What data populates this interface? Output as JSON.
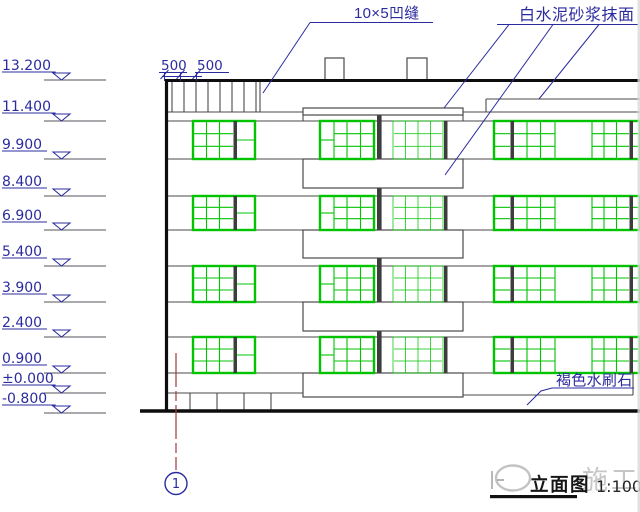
{
  "drawing": {
    "annotations": {
      "groove_label": "10×5凹缝",
      "white_cement_label": "白水泥砂浆抹面",
      "brown_stone_label": "褐色水刷石"
    },
    "dimension": {
      "seg1": "500",
      "seg2": "500"
    },
    "elevations": [
      "13.200",
      "11.400",
      "9.900",
      "8.400",
      "6.900",
      "5.400",
      "3.900",
      "2.400",
      "0.900",
      "±0.000",
      "-0.800"
    ],
    "axis_bubble": {
      "label": "1"
    },
    "title": {
      "text": "立面图",
      "scale": "1:100"
    },
    "watermark": {
      "text": "施工"
    },
    "colors": {
      "annotation_blue": "#2b2ba0",
      "window_green": "#00c400",
      "line_dark": "#4a4a4a",
      "axis_red": "#a03a3a",
      "watermark_gray": "#c6c6c6"
    }
  }
}
